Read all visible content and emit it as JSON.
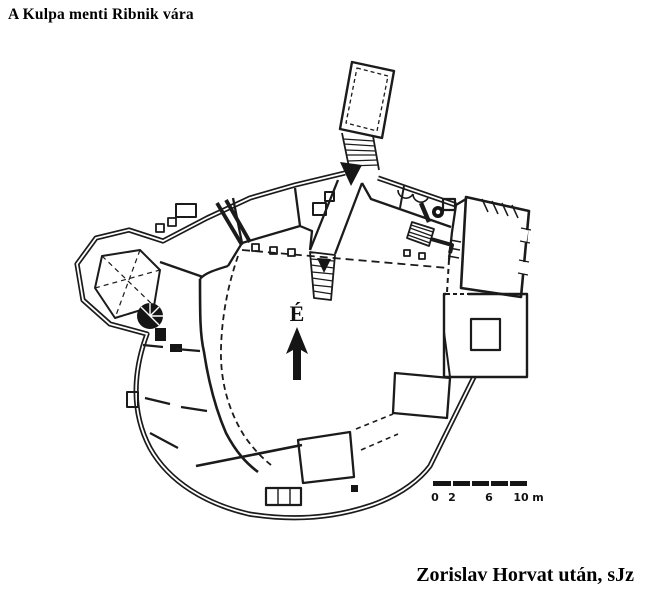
{
  "title": "A Kulpa menti Ribnik vára",
  "caption": "Zorislav Horvat után, sJz",
  "plan": {
    "name": "Ribnik castle ground plan",
    "north_label": "É"
  },
  "scale_bar": {
    "labels": [
      "0",
      "2",
      "6",
      "10"
    ],
    "unit": "m"
  },
  "colors": {
    "ink": "#1b1b1b",
    "paper": "#ffffff"
  }
}
